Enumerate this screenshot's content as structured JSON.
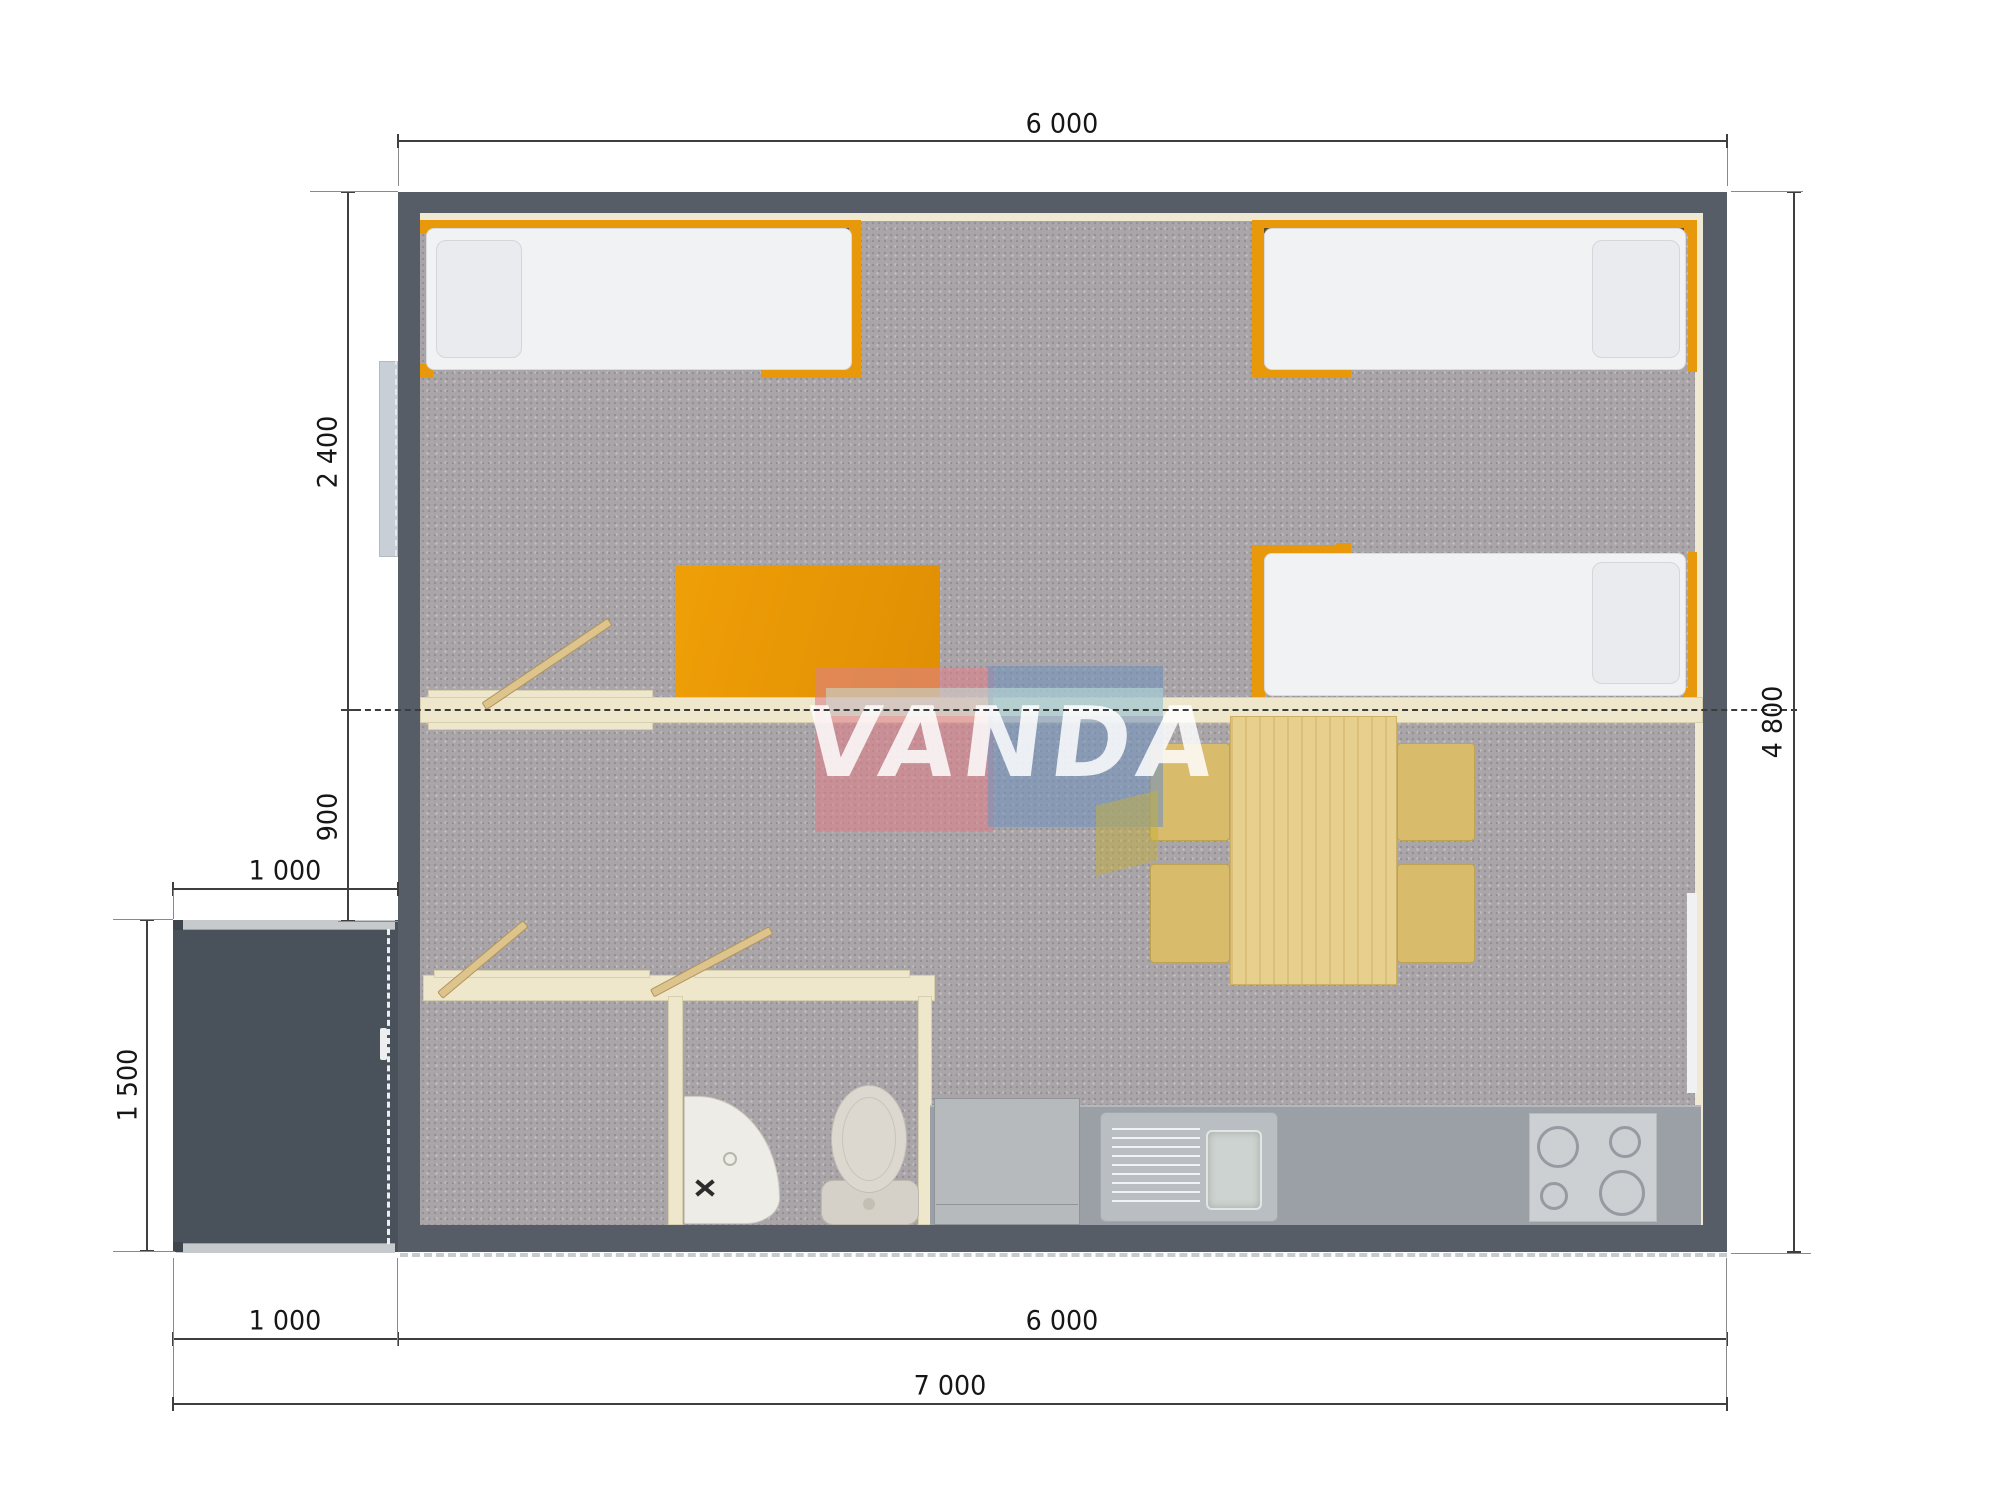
{
  "watermark": {
    "text": "VANDA",
    "pink": "#e0838e",
    "blue": "#7e9ac4",
    "teal": "#c8e8de"
  },
  "dimensions": {
    "top_width": "6 000",
    "right_height": "4 800",
    "left_bedroom_depth": "2 400",
    "left_living_strip": "900",
    "porch_width": "1 000",
    "porch_depth": "1 500",
    "bottom_porch_width": "1 000",
    "bottom_house_width": "6 000",
    "bottom_total_width": "7 000"
  },
  "colors": {
    "wall": "#575d66",
    "porch": "#49515b",
    "carpet": "#a9a5a8",
    "partition": "#efe7cc",
    "accent_orange": "#e8990b",
    "wood": "#e7cf8e",
    "chair": "#d8bc6b",
    "counter": "#9aa0a5",
    "stove": "#ccd0d3",
    "fixture_white": "#e9e7e0"
  }
}
